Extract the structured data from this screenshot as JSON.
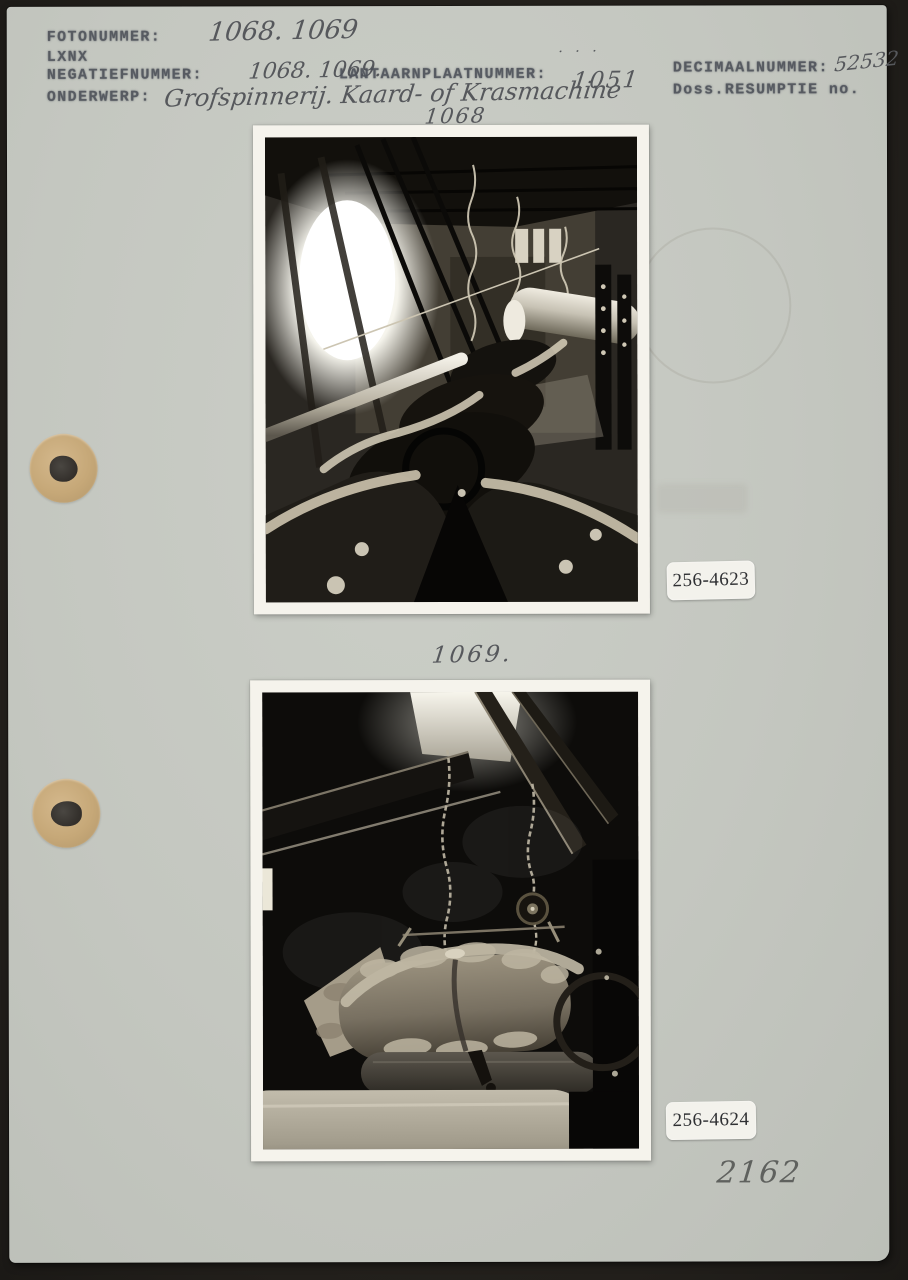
{
  "colors": {
    "card_background": "#c4c7c0",
    "scan_background": "#23211d",
    "typed_ink": "#4e525a",
    "handwriting_ink": "#56585c",
    "pencil": "#5f615e",
    "sticker_background": "#f3f2ec",
    "punch_ring": "#c6a878"
  },
  "header": {
    "fotonummer_label": "FOTONUMMER:",
    "fotonummer_value": "1068. 1069",
    "series_stamp": "LXNX",
    "negatiefnummer_label": "NEGATIEFNUMMER:",
    "negatiefnummer_value": "1068. 1069.",
    "lantaarnplaat_label": "LANTAARNPLAATNUMMER:",
    "lantaarnplaat_dots": ". . .",
    "lantaarnplaat_value": "1051",
    "decimaalnummer_label": "DECIMAALNUMMER:",
    "decimaalnummer_value": "52532",
    "doss_resumptie_label": "Doss.RESUMPTIE no.",
    "onderwerp_label": "ONDERWERP:",
    "onderwerp_value": "Grofspinnerij. Kaard- of Krasmachine",
    "onderwerp_photo_number": "1068"
  },
  "photos": {
    "top": {
      "sticker_label": "256-4623"
    },
    "bottom": {
      "handwritten_caption": "1069.",
      "sticker_label": "256-4624"
    }
  },
  "annotations": {
    "pencil_number": "2162"
  }
}
